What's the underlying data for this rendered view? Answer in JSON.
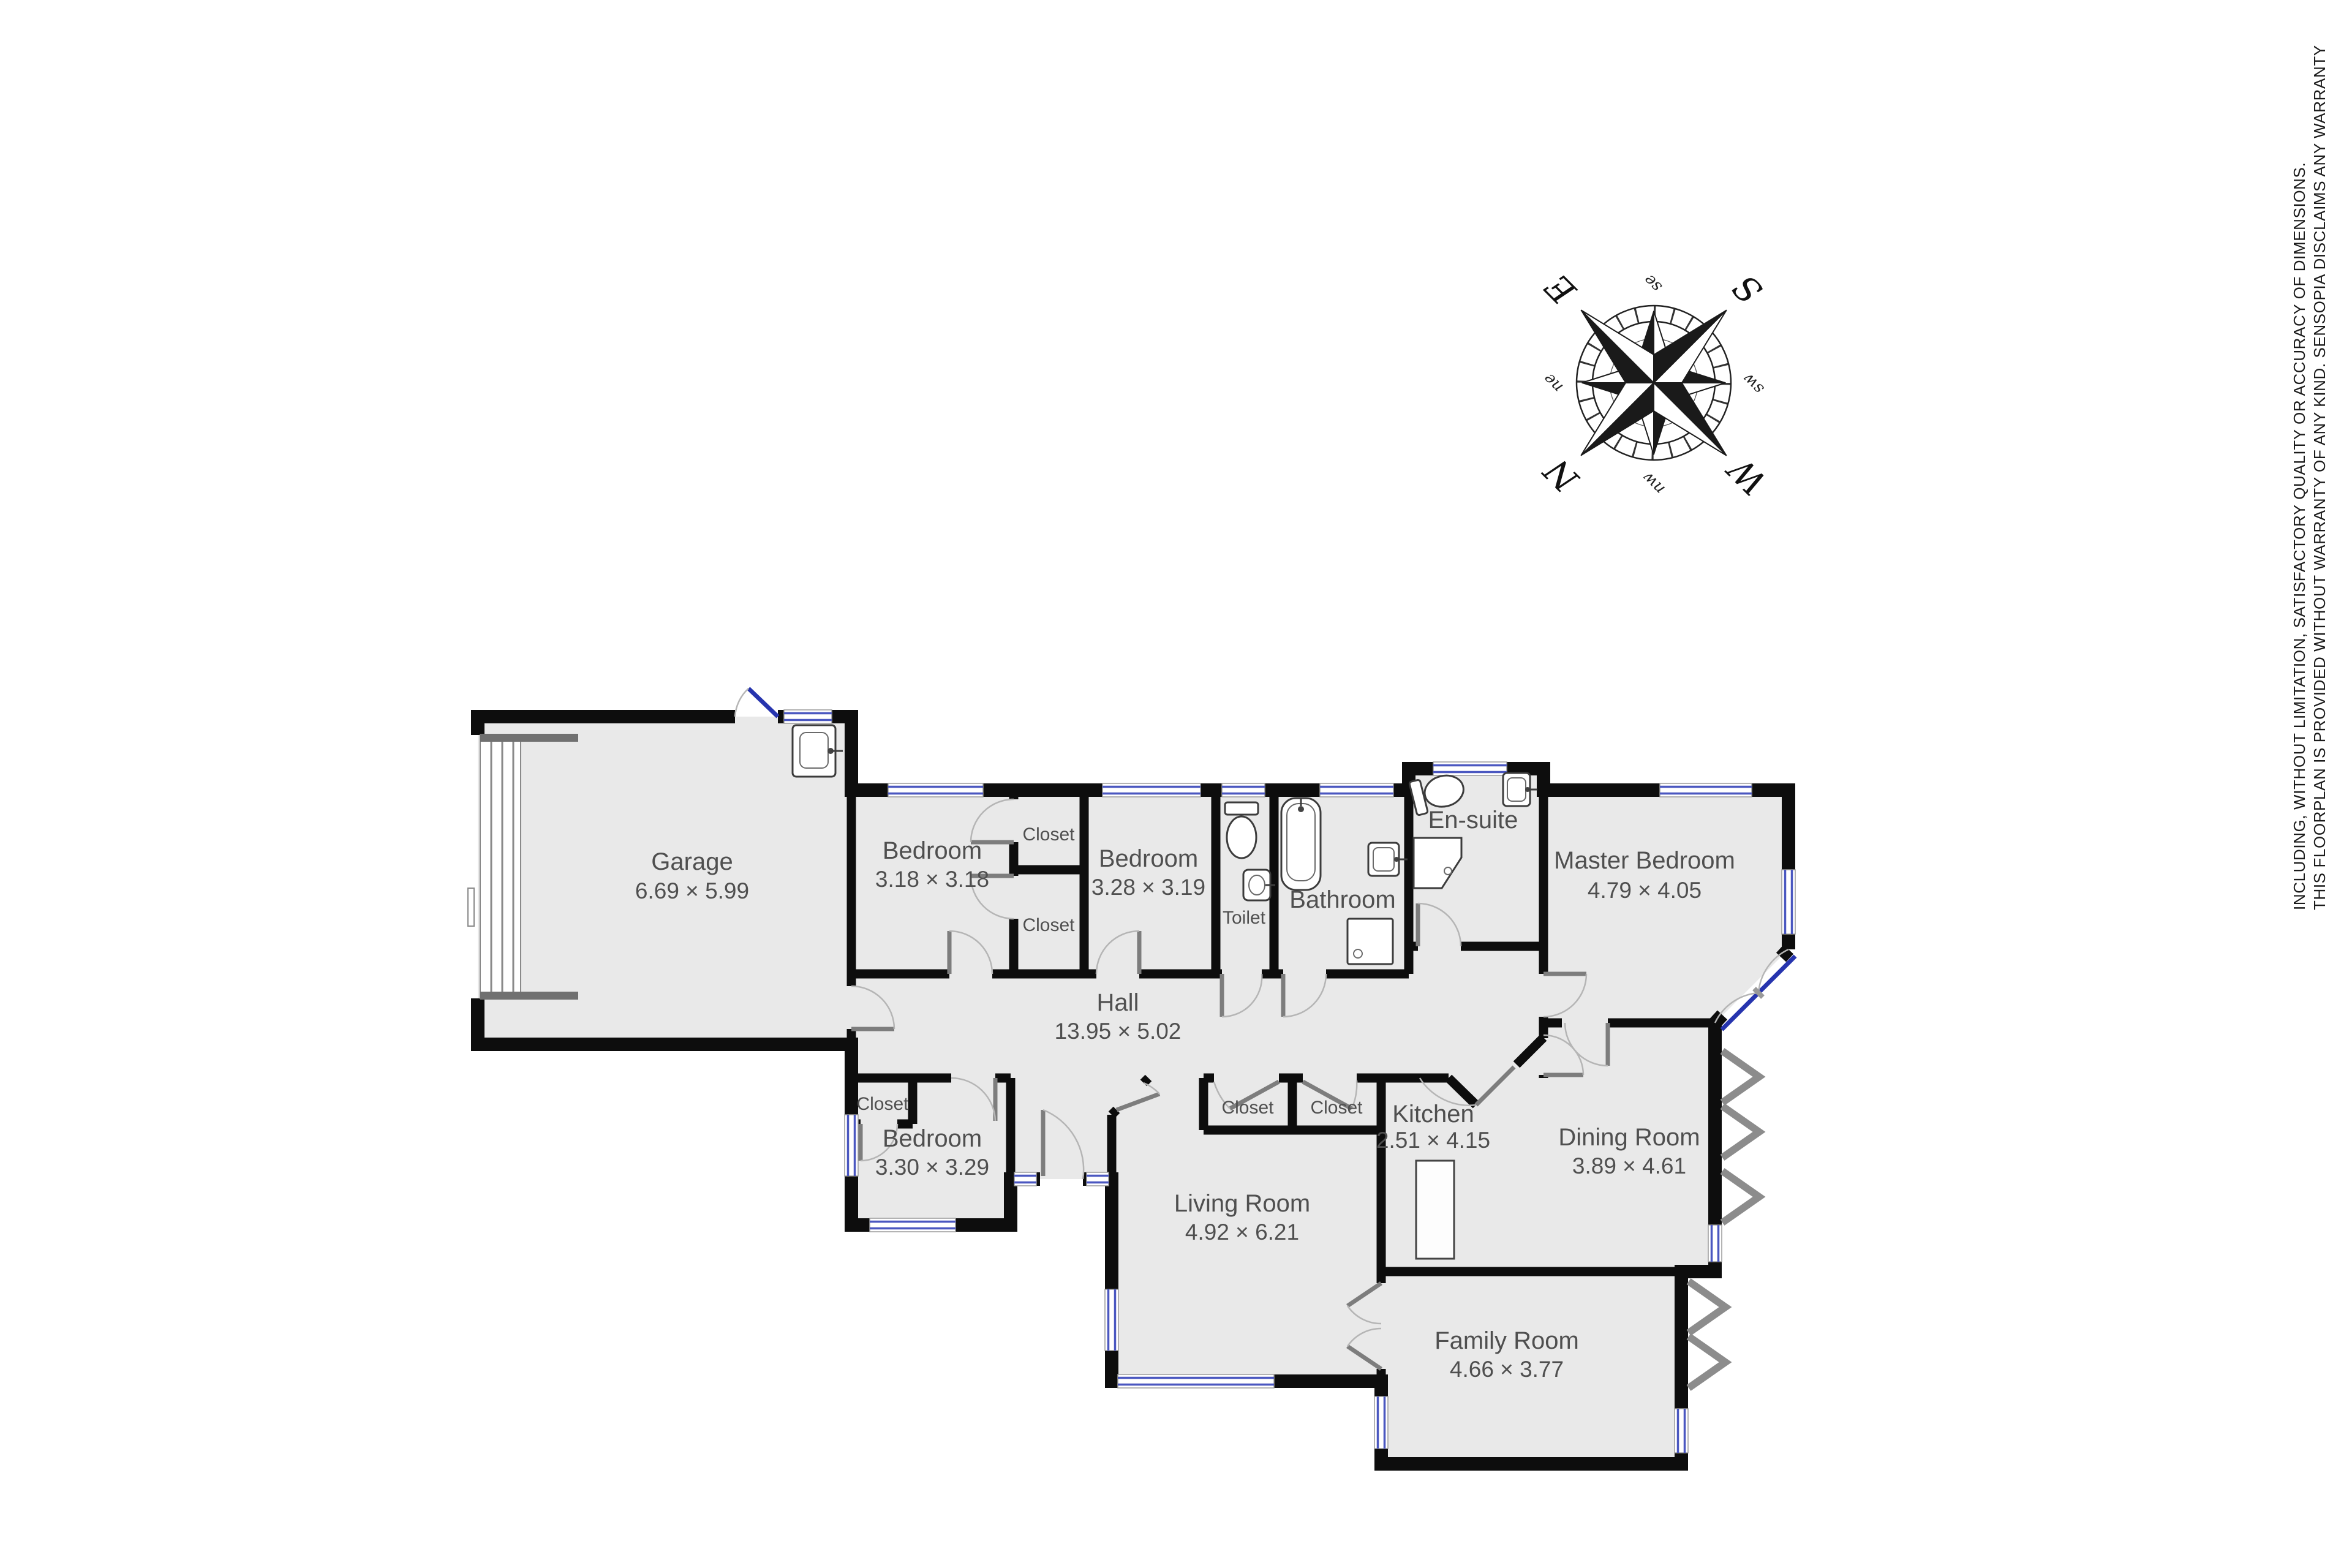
{
  "disclaimer": {
    "line1": "THIS FLOORPLAN IS PROVIDED WITHOUT WARRANTY OF ANY KIND. SENSOPIA DISCLAIMS ANY WARRANTY",
    "line2": "INCLUDING, WITHOUT LIMITATION, SATISFACTORY QUALITY OR ACCURACY OF DIMENSIONS."
  },
  "compass": {
    "cardinals": {
      "n": "N",
      "e": "E",
      "s": "S",
      "w": "W"
    },
    "intercardinals": {
      "ne": "ne",
      "se": "se",
      "sw": "sw",
      "nw": "nw"
    }
  },
  "rooms": {
    "garage": {
      "name": "Garage",
      "dims": "6.69 × 5.99"
    },
    "bedroom_top": {
      "name": "Bedroom",
      "dims": "3.18 × 3.18"
    },
    "closet_top_a": {
      "name": "Closet"
    },
    "closet_top_b": {
      "name": "Closet"
    },
    "bedroom_middle": {
      "name": "Bedroom",
      "dims": "3.28 × 3.19"
    },
    "toilet": {
      "name": "Toilet"
    },
    "bathroom": {
      "name": "Bathroom"
    },
    "ensuite": {
      "name": "En-suite"
    },
    "master_bedroom": {
      "name": "Master Bedroom",
      "dims": "4.79 × 4.05"
    },
    "hall": {
      "name": "Hall",
      "dims": "13.95 × 5.02"
    },
    "closet_hall_left": {
      "name": "Closet"
    },
    "bedroom_bottom": {
      "name": "Bedroom",
      "dims": "3.30 × 3.29"
    },
    "closet_mid_left": {
      "name": "Closet"
    },
    "closet_mid_right": {
      "name": "Closet"
    },
    "kitchen": {
      "name": "Kitchen",
      "dims": "2.51 × 4.15"
    },
    "dining": {
      "name": "Dining Room",
      "dims": "3.89 × 4.61"
    },
    "living": {
      "name": "Living Room",
      "dims": "4.92 × 6.21"
    },
    "family": {
      "name": "Family Room",
      "dims": "4.66 × 3.77"
    }
  },
  "colors": {
    "floor": "#e9e9e9",
    "wall": "#0d0d0d",
    "window": "#4a57c0",
    "door_interior": "#7d7d7d",
    "door_exterior": "#2634ae",
    "label": "#4f4f4f"
  }
}
